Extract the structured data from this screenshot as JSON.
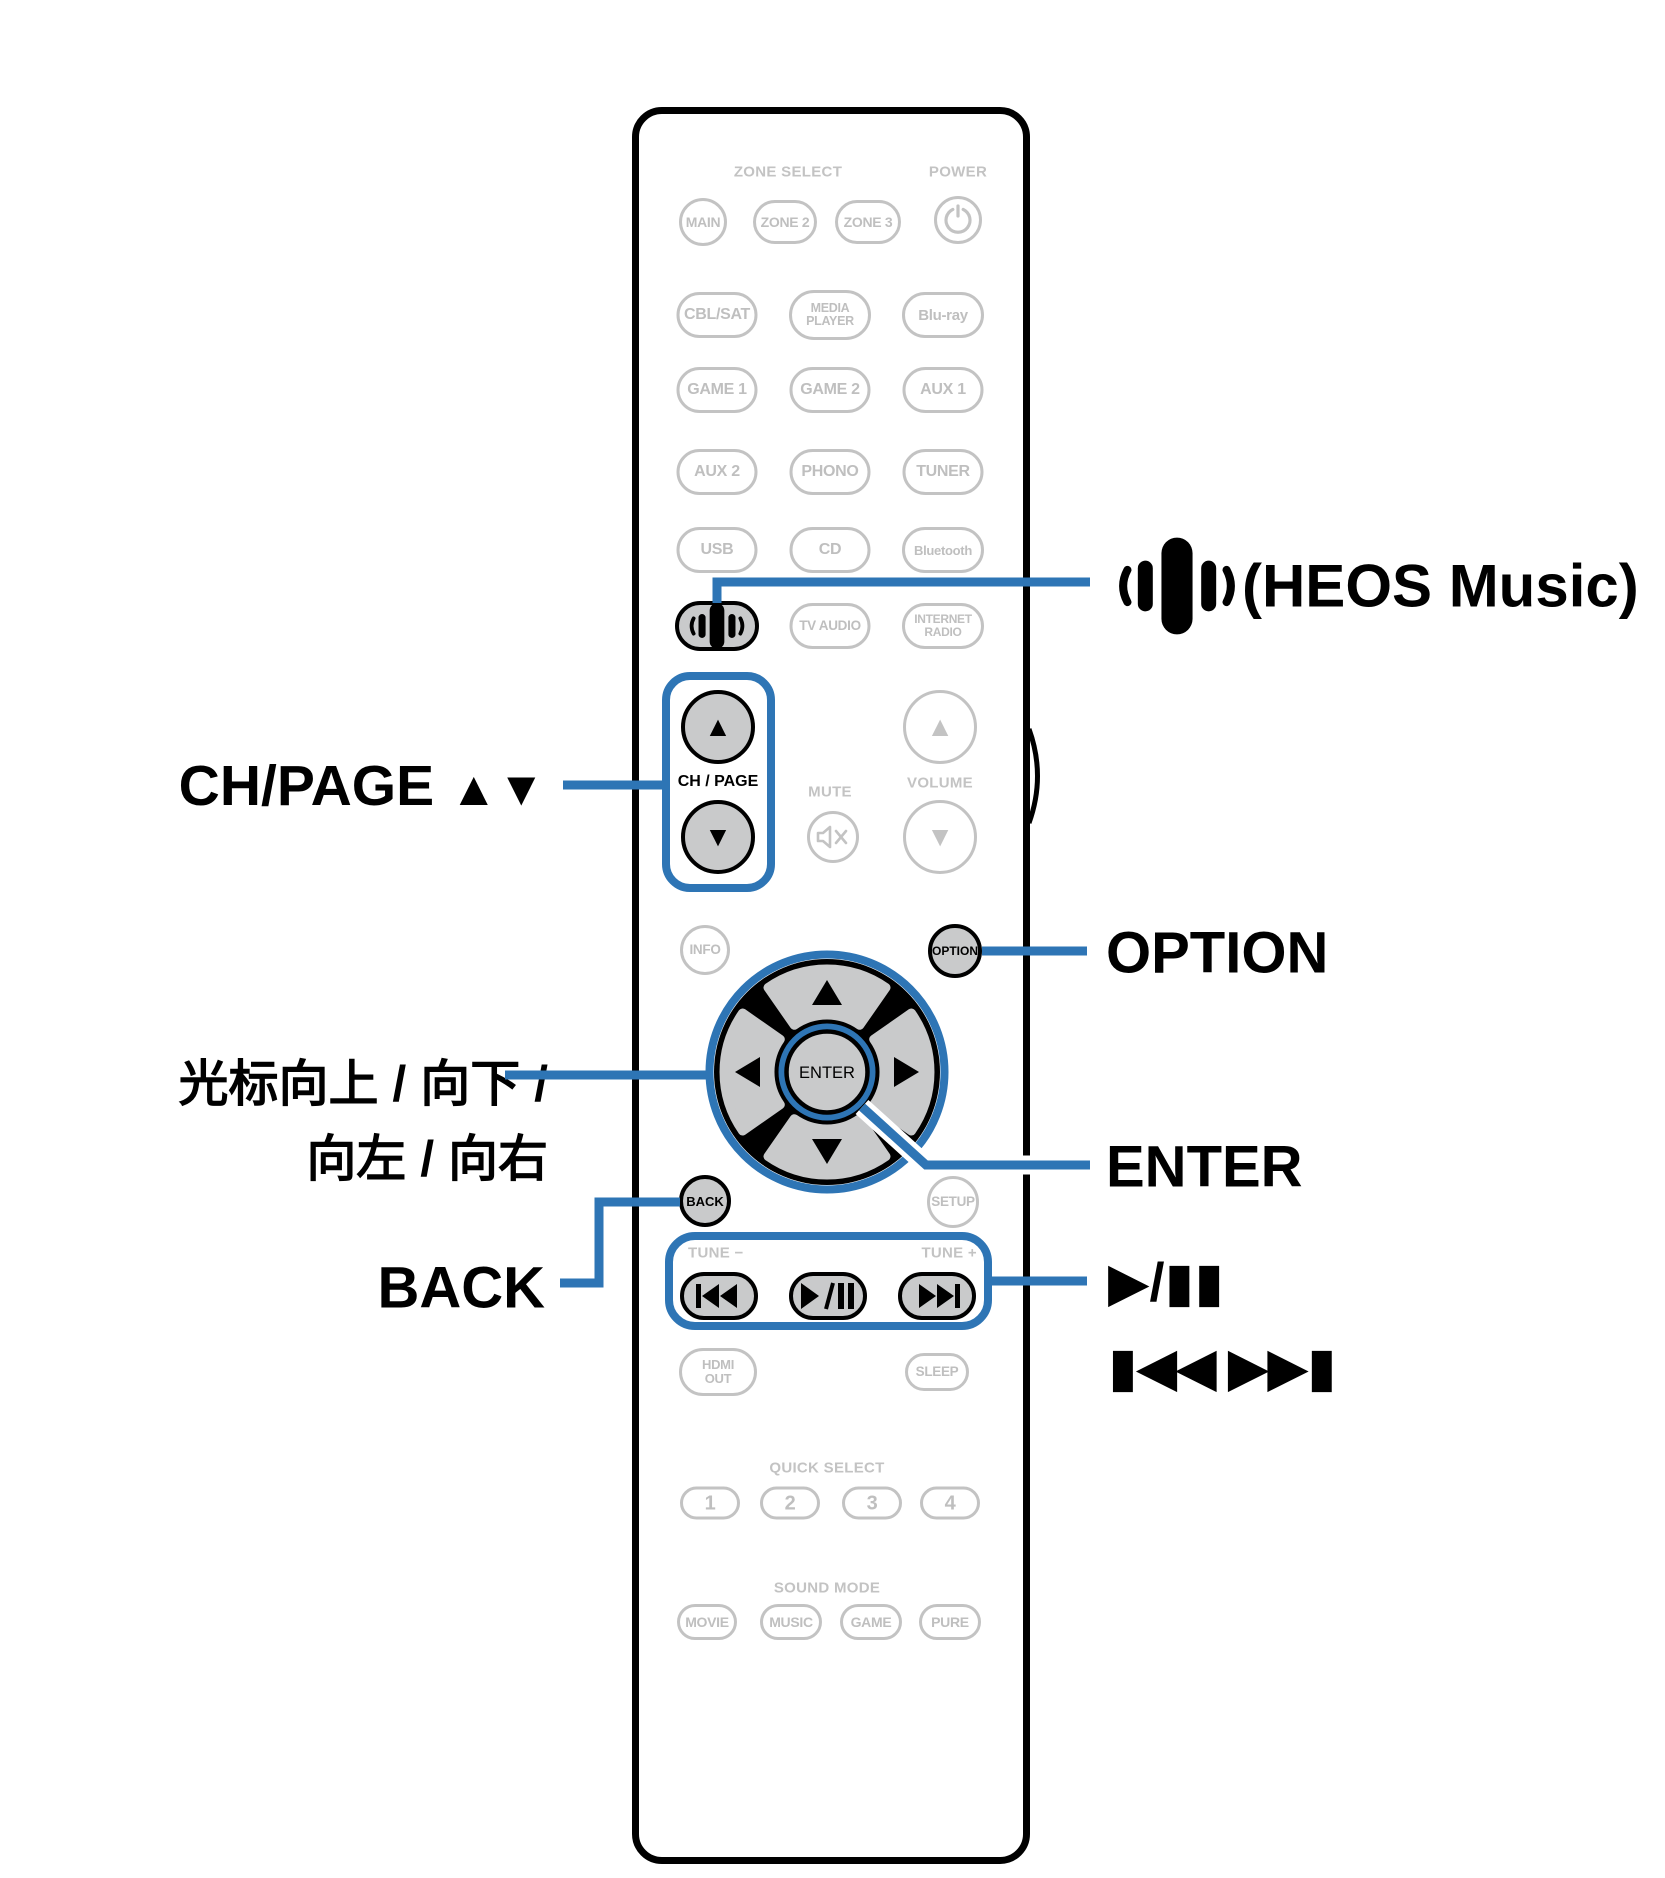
{
  "colors": {
    "accent": "#2E75B5",
    "inactive_gray": "#C3C3C3",
    "button_fill": "#C9CACB",
    "outline": "#000000"
  },
  "callouts": {
    "heos": {
      "icon": "heos-music-icon",
      "label": "(HEOS Music)"
    },
    "ch_page": {
      "label": "CH/PAGE",
      "arrows": "▲▼"
    },
    "cursor": {
      "line1": "光标向上 / 向下 /",
      "line2": "向左 / 向右"
    },
    "back": {
      "label": "BACK"
    },
    "option": {
      "label": "OPTION"
    },
    "enter": {
      "label": "ENTER"
    },
    "play_pause": {
      "label": "▶/▮▮"
    },
    "skip": {
      "label": "▮◀◀ ▶▶▮"
    }
  },
  "remote": {
    "zone_select_header": "ZONE SELECT",
    "power_header": "POWER",
    "buttons": {
      "main": "MAIN",
      "zone2": "ZONE 2",
      "zone3": "ZONE 3",
      "cbl_sat": "CBL/SAT",
      "media_player_line1": "MEDIA",
      "media_player_line2": "PLAYER",
      "blu_ray": "Blu-ray",
      "game1": "GAME 1",
      "game2": "GAME 2",
      "aux1": "AUX 1",
      "aux2": "AUX 2",
      "phono": "PHONO",
      "tuner": "TUNER",
      "usb": "USB",
      "cd": "CD",
      "bluetooth": "Bluetooth",
      "tv_audio": "TV AUDIO",
      "internet_radio_line1": "INTERNET",
      "internet_radio_line2": "RADIO",
      "ch_page_label": "CH / PAGE",
      "mute_label": "MUTE",
      "volume_label": "VOLUME",
      "info": "INFO",
      "option": "OPTION",
      "enter": "ENTER",
      "back": "BACK",
      "setup": "SETUP",
      "tune_minus": "TUNE −",
      "tune_plus": "TUNE +",
      "hdmi_line1": "HDMI",
      "hdmi_line2": "OUT",
      "sleep": "SLEEP",
      "quick_select_header": "QUICK SELECT",
      "q1": "1",
      "q2": "2",
      "q3": "3",
      "q4": "4",
      "sound_mode_header": "SOUND MODE",
      "movie": "MOVIE",
      "music": "MUSIC",
      "game": "GAME",
      "pure": "PURE",
      "up_arrow": "▲",
      "down_arrow": "▼"
    }
  }
}
